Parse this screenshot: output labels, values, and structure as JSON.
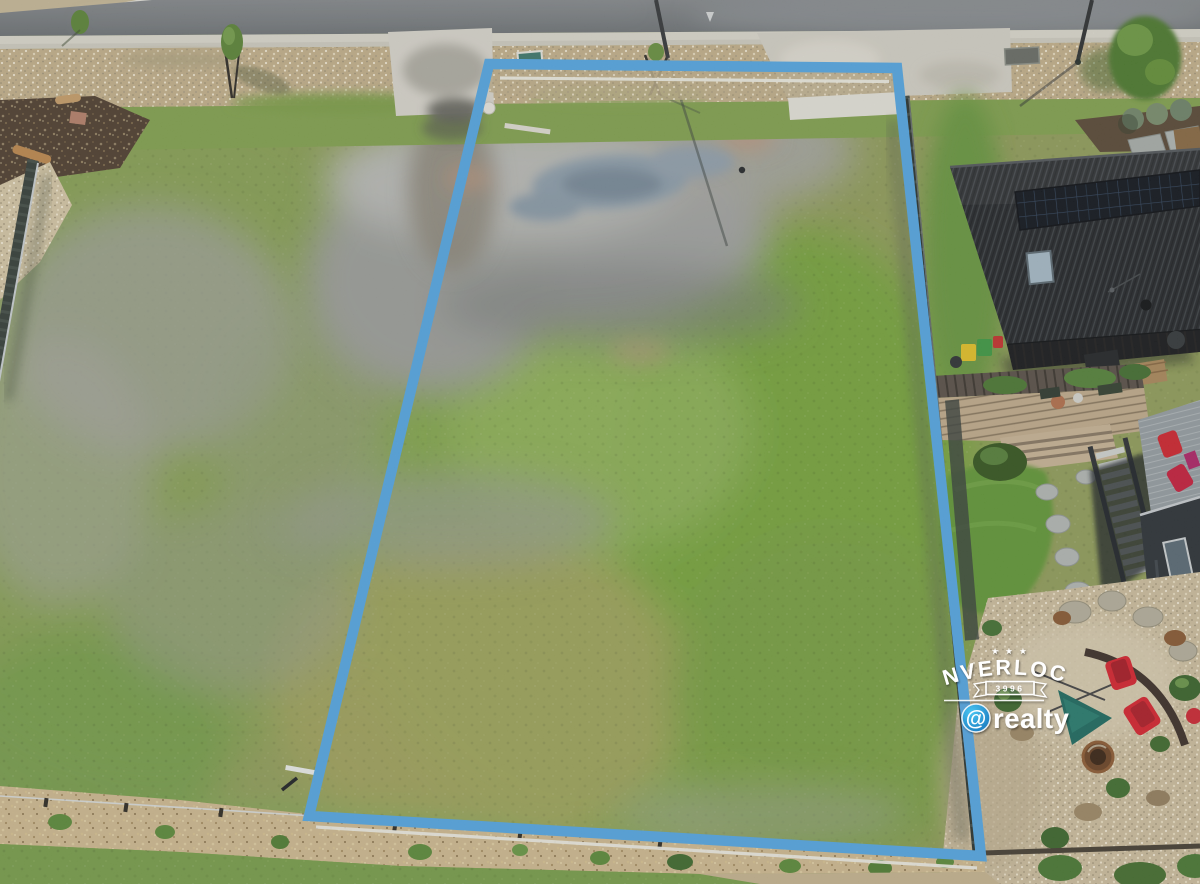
{
  "meta": {
    "type": "aerial-drone-photograph",
    "description": "Overhead drone photo of a vacant grassy residential block outlined with a blue boundary line; street at top, modern dark-roofed house with solar panels and landscaped yard on the right."
  },
  "boundary": {
    "color": "#55aae8",
    "accent": "#f2f1e6"
  },
  "watermark": {
    "stars": "★ ★ ★",
    "town": "INVERLOCH",
    "postcode": "3996",
    "at_symbol": "@",
    "brand": "realty",
    "text_color": "#ffffff",
    "at_blue_light": "#4ac6f2",
    "at_blue_dark": "#1470b8"
  }
}
